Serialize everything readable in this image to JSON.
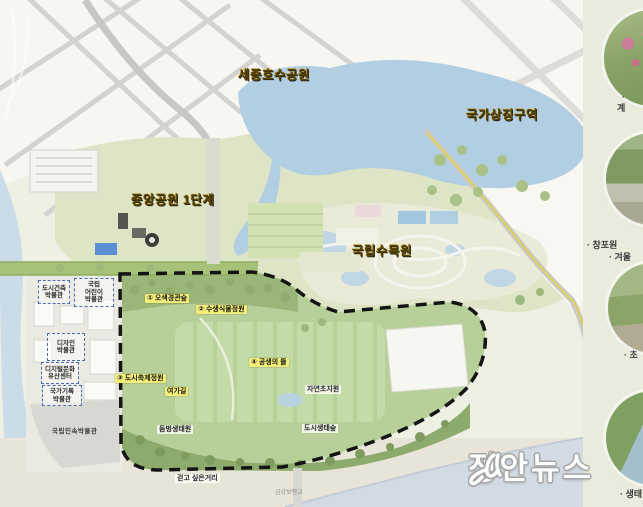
{
  "map": {
    "regions": [
      {
        "label": "세종호수공원"
      },
      {
        "label": "국가상징구역"
      },
      {
        "label": "중앙공원 1단계"
      },
      {
        "label": "국립수목원"
      }
    ],
    "zones": [
      {
        "label": "① 오색경관숲"
      },
      {
        "label": "② 수생식물정원"
      },
      {
        "label": "④ 공생의 뜰"
      },
      {
        "label": "③ 도시축제정원"
      },
      {
        "label": "여가길"
      }
    ],
    "places": [
      {
        "label": "둠벙생태원"
      },
      {
        "label": "도시생태숲"
      },
      {
        "label": "자연초지원"
      },
      {
        "label": "걷고 싶은거리"
      }
    ],
    "bridge_label": "금강보행교",
    "museums": [
      {
        "lines": [
          "도시건축",
          "박물관"
        ]
      },
      {
        "lines": [
          "국립",
          "어린이",
          "박물관"
        ]
      },
      {
        "lines": [
          "디자인",
          "박물관"
        ]
      },
      {
        "lines": [
          "디지털문화",
          "유산센터"
        ]
      },
      {
        "lines": [
          "국가기록",
          "박물관"
        ]
      }
    ],
    "folk_museum_label": "국립민속박물관"
  },
  "sidebar": {
    "thumbnails": [
      {
        "name": "flower-garden-photo",
        "caption_lines": [
          "·",
          "계"
        ]
      },
      {
        "name": "tree-garden-photo",
        "caption_lines": [
          "· 창포원",
          "· 겨울"
        ]
      },
      {
        "name": "terrace-garden-photo",
        "caption_lines": [
          "· 초"
        ]
      },
      {
        "name": "stream-aerial-photo",
        "caption_lines": [
          "· 생태"
        ]
      }
    ]
  },
  "watermark": {
    "name": "정안뉴스"
  },
  "colors": {
    "lake_blue": "#b2cee2",
    "park_green": "#dde5c6",
    "lawn_green": "#c3dba6",
    "boundary_black": "#141414",
    "label_gold": "#5a4708",
    "zone_highlight": "#f3ee79",
    "museum_dashed_blue": "#4a6cb3",
    "sidebar_bg": "#e9ecdc"
  }
}
